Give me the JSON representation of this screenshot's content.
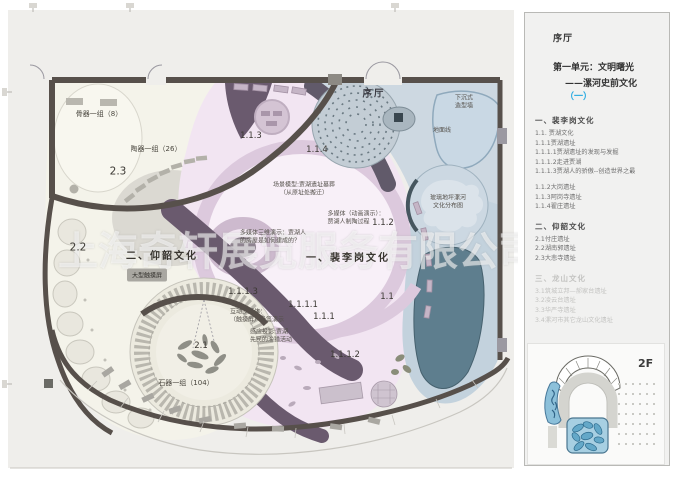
{
  "watermark": "上海奇轩展览服务有限公司",
  "colors": {
    "accent": "#29abe2",
    "wall": "#57504b",
    "zone_pink": "#f2e5f2",
    "zone_cream": "#f4f3ea",
    "zone_blue": "#cdd8e1",
    "corridor_purple": "#6a5a6e"
  },
  "sidebar": {
    "hall": "序厅",
    "unit_line1": "第一单元：文明曙光",
    "unit_line2": "——漯河史前文化",
    "unit_paren": "（一）",
    "sections": [
      {
        "heading": "一、裴李岗文化",
        "items": [
          "1.1. 贾湖文化",
          "1.1.1贾湖遗址",
          "1.1.1.1贾湖遗址的发现与发掘",
          "1.1.1.2走进贾湖",
          "1.1.1.3贾湖人的骄傲--创造世界之最",
          "1.1.2大岗遗址",
          "1.1.3阿岗寺遗址",
          "1.1.4翟庄遗址"
        ]
      },
      {
        "heading": "二、仰韶文化",
        "items": [
          "2.1付庄遗址",
          "2.2湖南郭遗址",
          "2.3大悲寺遗址"
        ]
      },
      {
        "heading": "三、龙山文化",
        "items": [
          "3.1筑城立邦—郝家台遗址",
          "3.2凌云台遗址",
          "3.3华严寺遗址",
          "3.4漯河市其它龙山文化遗址"
        ]
      }
    ],
    "floor_label": "2F"
  },
  "plan": {
    "labels": [
      {
        "name": "hall-label",
        "text": "序厅"
      },
      {
        "name": "sunken-wall-label",
        "text": "下沉式\n造型墙"
      },
      {
        "name": "ground-line-label",
        "text": "地面线"
      },
      {
        "name": "glass-floor-label",
        "text": "玻璃地坪漯河\n文化分布图"
      },
      {
        "name": "bone-group-label",
        "text": "骨器一组（8）"
      },
      {
        "name": "pottery-group-label",
        "text": "陶器一组（26）"
      },
      {
        "name": "zone-2-3-label",
        "text": "2.3"
      },
      {
        "name": "zone-2-2-label",
        "text": "2.2"
      },
      {
        "name": "yangshao-title",
        "text": "二、仰韶文化"
      },
      {
        "name": "touchscreen-chip",
        "text": "大型触摸屏"
      },
      {
        "name": "zone-2-1-label",
        "text": "2.1"
      },
      {
        "name": "stone-group-label",
        "text": "石器一组（104）"
      },
      {
        "name": "zone-1-1-3-label",
        "text": "1.1.3"
      },
      {
        "name": "zone-1-1-4-label",
        "text": "1.1.4"
      },
      {
        "name": "scene-model-label",
        "text": "场景模型:贾湖遗址墓葬\n（从原址处搬迁）"
      },
      {
        "name": "media-animation-label",
        "text": "多媒体（动画演示）：\n贾湖人制陶过程"
      },
      {
        "name": "zone-1-1-2-label",
        "text": "1.1.2"
      },
      {
        "name": "media-3d-label",
        "text": "多媒体三维演示：贾湖人\n的房屋是如何建成的？"
      },
      {
        "name": "peiligang-title",
        "text": "一、裴李岗文化"
      },
      {
        "name": "zone-1-1-label",
        "text": "1.1"
      },
      {
        "name": "zone-1-1-1-1-label",
        "text": "1.1.1.1"
      },
      {
        "name": "zone-1-1-1-label",
        "text": "1.1.1"
      },
      {
        "name": "zone-1-1-1-3-label",
        "text": "1.1.1.3"
      },
      {
        "name": "flute-media-label",
        "text": "互动多媒体：\n（触摸屏）骨笛演示"
      },
      {
        "name": "projection-label",
        "text": "感应投影:贾湖\n先民的渔猎活动"
      },
      {
        "name": "zone-1-1-1-2-label",
        "text": "1.1.1.2"
      }
    ]
  }
}
